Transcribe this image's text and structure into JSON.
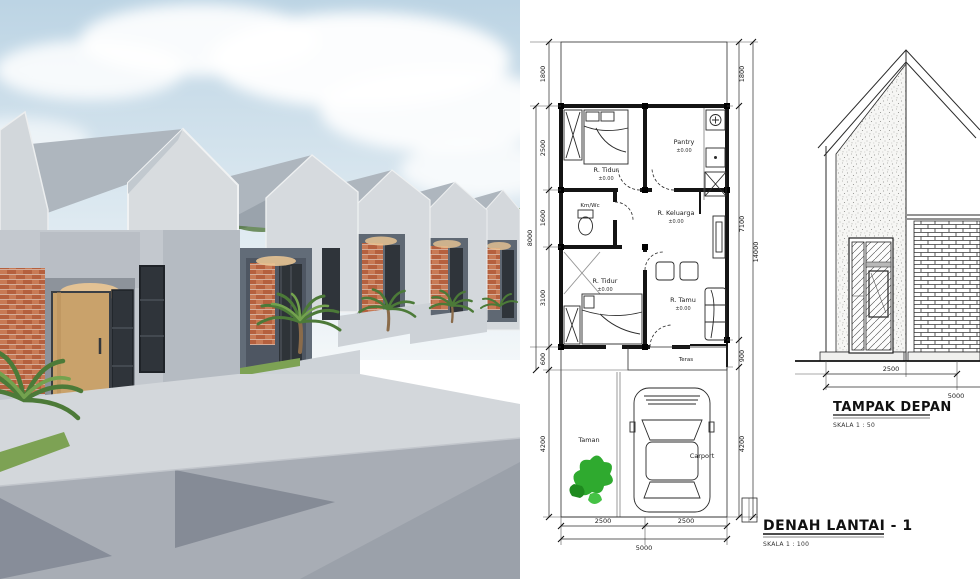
{
  "floor_plan": {
    "title": "DENAH LANTAI - 1",
    "scale": "SKALA 1 : 100",
    "rooms": [
      {
        "name": "R. Tidur",
        "elev": "±0.00"
      },
      {
        "name": "Pantry",
        "elev": "±0.00"
      },
      {
        "name": "Km/Wc",
        "elev": ""
      },
      {
        "name": "R. Keluarga",
        "elev": "±0.00"
      },
      {
        "name": "R. Tidur",
        "elev": "±0.00"
      },
      {
        "name": "R. Tamu",
        "elev": "±0.00"
      },
      {
        "name": "Teras",
        "elev": ""
      },
      {
        "name": "Taman",
        "elev": ""
      },
      {
        "name": "Carport",
        "elev": ""
      }
    ],
    "dimensions": {
      "left": [
        "1800",
        "2500",
        "1600",
        "3100",
        "600",
        "4200"
      ],
      "left_overall": "8000",
      "right": [
        "1800",
        "7100",
        "900",
        "4200"
      ],
      "right_overall": "14000",
      "bottom": [
        "2500",
        "2500"
      ],
      "bottom_overall": "5000"
    }
  },
  "elevation": {
    "title": "TAMPAK DEPAN",
    "scale": "SKALA 1 : 50",
    "dimensions": {
      "bottom_left": "2500",
      "bottom_overall": "5000"
    }
  },
  "colors": {
    "sky_top": "#bcd4e4",
    "sky_bottom": "#f3f7f9",
    "cloud": "#ffffff",
    "roof_light": "#d8dcdf",
    "roof_mid": "#aeb6be",
    "facade": "#c3c8ce",
    "facade_shade": "#b5bbc2",
    "porch_dark": "#5f6873",
    "brick": "#b5603e",
    "brick_light": "#c87a55",
    "wood_door": "#c9a26b",
    "glass_dark": "#2f343a",
    "warm_light": "#e8c493",
    "road": "#a8adb5",
    "pad": "#d3d7db",
    "shadow": "#7f8591",
    "plant_dark": "#46743a",
    "plant_light": "#6fa050",
    "taman_plant": "#2faa2f",
    "paper": "#ffffff",
    "line": "#1a1a1a"
  }
}
